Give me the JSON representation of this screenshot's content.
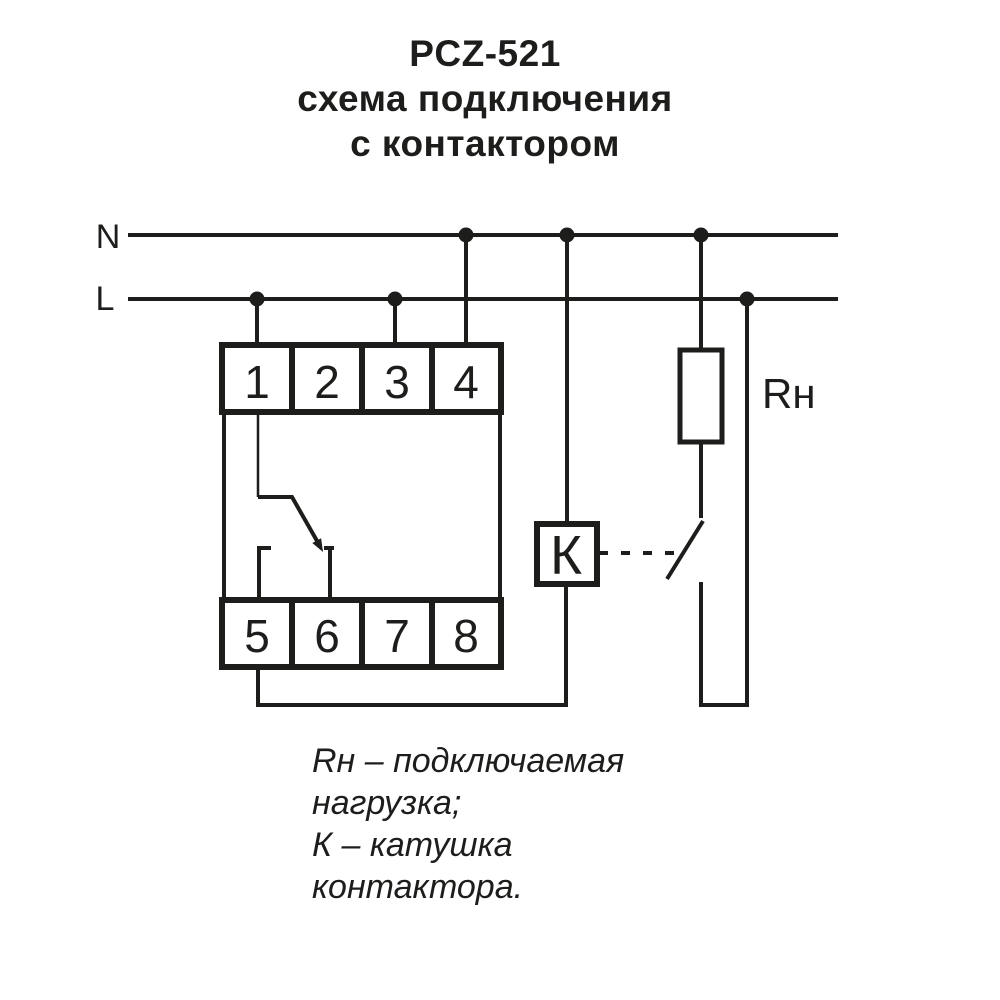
{
  "title": {
    "line1": "PCZ-521",
    "line2": "схема подключения",
    "line3": "с контактором"
  },
  "bus": {
    "n_label": "N",
    "l_label": "L"
  },
  "device": {
    "terminals_top": [
      "1",
      "2",
      "3",
      "4"
    ],
    "terminals_bottom": [
      "5",
      "6",
      "7",
      "8"
    ]
  },
  "contactor": {
    "coil_label": "К"
  },
  "load": {
    "label": "Rн"
  },
  "caption": {
    "line1": "Rн – подключаемая",
    "line2": "нагрузка;",
    "line3": "К – катушка",
    "line4": "контактора."
  },
  "colors": {
    "ink": "#1d1d1b",
    "background": "#ffffff"
  }
}
